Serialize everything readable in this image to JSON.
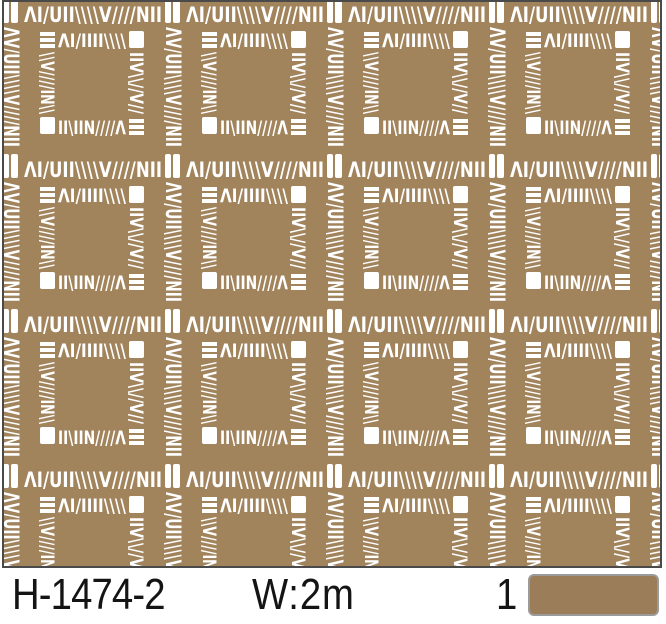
{
  "product": {
    "code": "H-1474-2",
    "width_label": "W:2m",
    "quantity": "1"
  },
  "colors": {
    "pattern_background": "#a1835c",
    "pattern_marks": "#ffffff",
    "frame_border": "#4a4a4a",
    "swatch_fill": "#9b7e59",
    "swatch_border": "#9b9b9b",
    "label_text": "#141414",
    "page_background": "#ffffff"
  },
  "pattern": {
    "description": "brown wallpaper swatch with white hand-drawn square lattice motif, 4x4 tile repeat",
    "h_band": "ΛI/UII\\\\\\\\V////NII",
    "v_band": "ΛV/UII\\\\\\\\V////NII",
    "inner_top": "ΛI/IIII\\\\\\\\",
    "inner_bottom": "II\\IIN////Λ",
    "inner_left": "\\\\V////IN\\\\",
    "inner_right": "IIV\\\\//V//"
  }
}
